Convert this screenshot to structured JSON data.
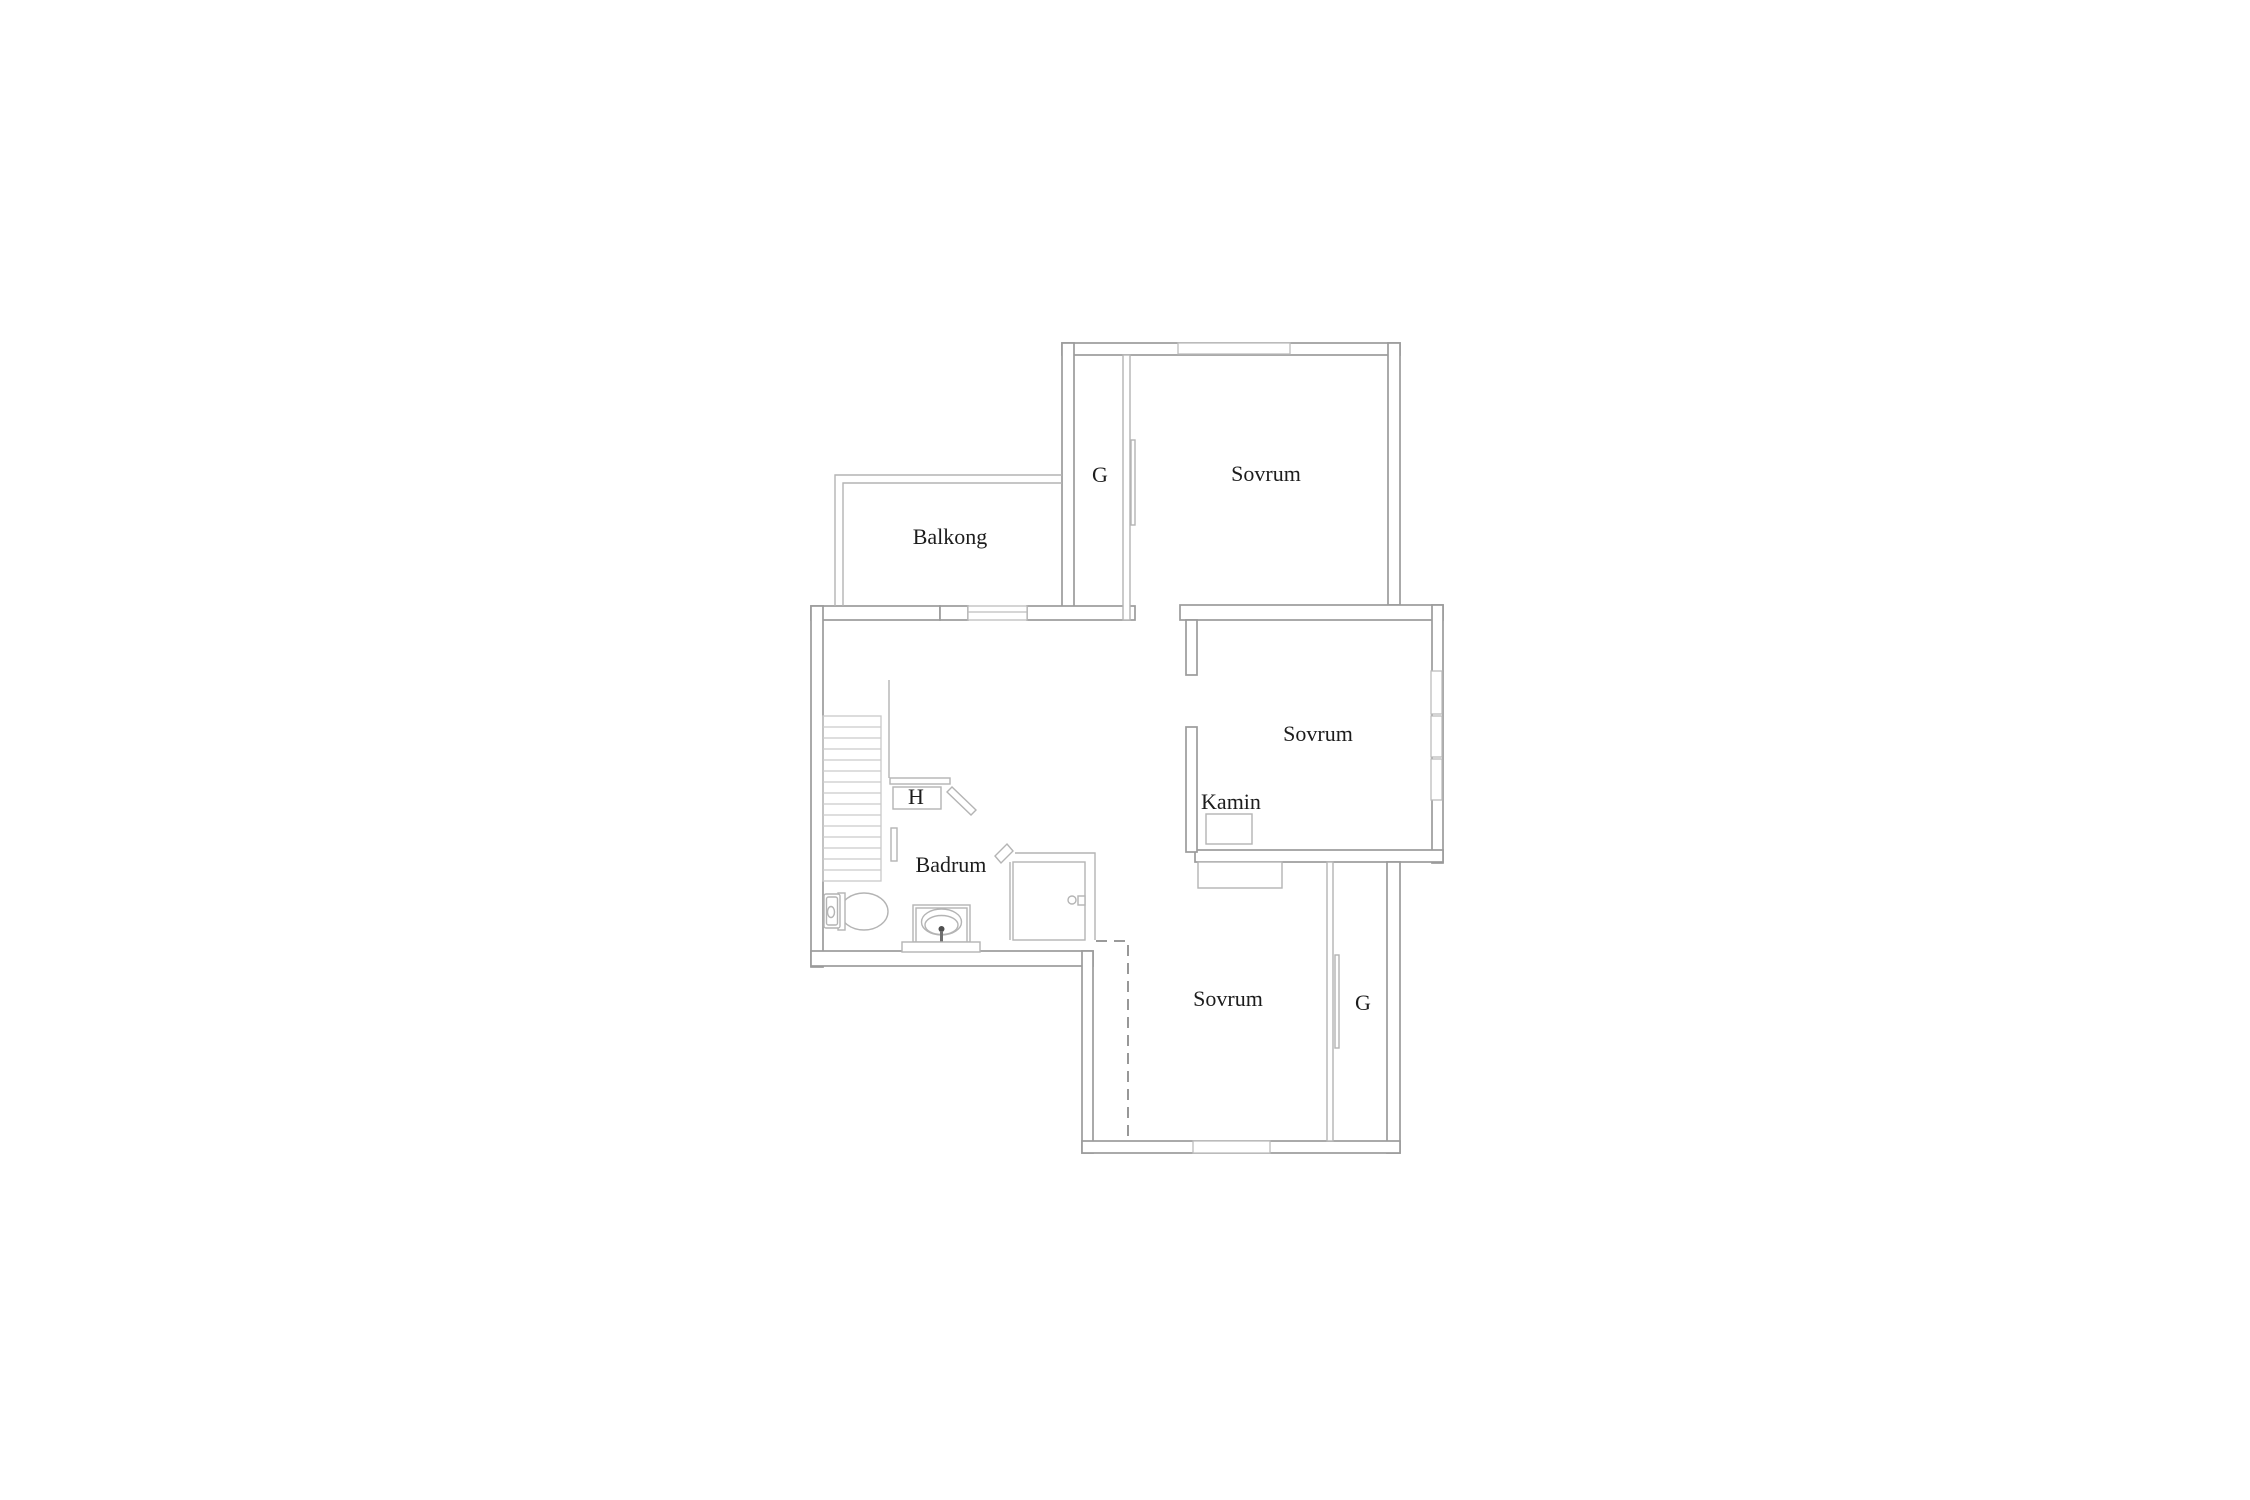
{
  "page": {
    "background": "#ffffff",
    "type_note": "Floor plan drawing, upper storey"
  },
  "palette": {
    "page_bg": "#ffffff",
    "wall_outer": "#9b9b9b",
    "wall_inner": "#b4b4b4",
    "window_line": "#bdbdbd",
    "fixture_line": "#b4b4b4",
    "stairs_line": "#c9c9c9",
    "dashed_line": "#8c8c8c",
    "label_color": "#1d1d1d"
  },
  "rooms": {
    "balkong": {
      "label": "Balkong",
      "x": 950,
      "y": 544
    },
    "closet_top": {
      "label": "G",
      "x": 1100,
      "y": 482
    },
    "sovrum_top": {
      "label": "Sovrum",
      "x": 1266,
      "y": 481
    },
    "sovrum_mid": {
      "label": "Sovrum",
      "x": 1318,
      "y": 741
    },
    "kamin": {
      "label": "Kamin",
      "x": 1231,
      "y": 809
    },
    "badrum": {
      "label": "Badrum",
      "x": 951,
      "y": 872
    },
    "closet_h": {
      "label": "H",
      "x": 916,
      "y": 804
    },
    "sovrum_bottom": {
      "label": "Sovrum",
      "x": 1228,
      "y": 1006
    },
    "closet_bottom": {
      "label": "G",
      "x": 1363,
      "y": 1010
    }
  },
  "fixtures": [
    "staircase",
    "stair-handrail",
    "closet-h",
    "door-leaf",
    "toilet",
    "sink",
    "vanity-counter",
    "shower",
    "shower-door-handle",
    "fireplace",
    "wardrobe-niche",
    "sliding-door-top",
    "sliding-door-bottom",
    "window-top",
    "window-balcony",
    "window-east-1",
    "window-east-2",
    "window-east-3",
    "window-south",
    "ceiling-break-dashed-line"
  ]
}
